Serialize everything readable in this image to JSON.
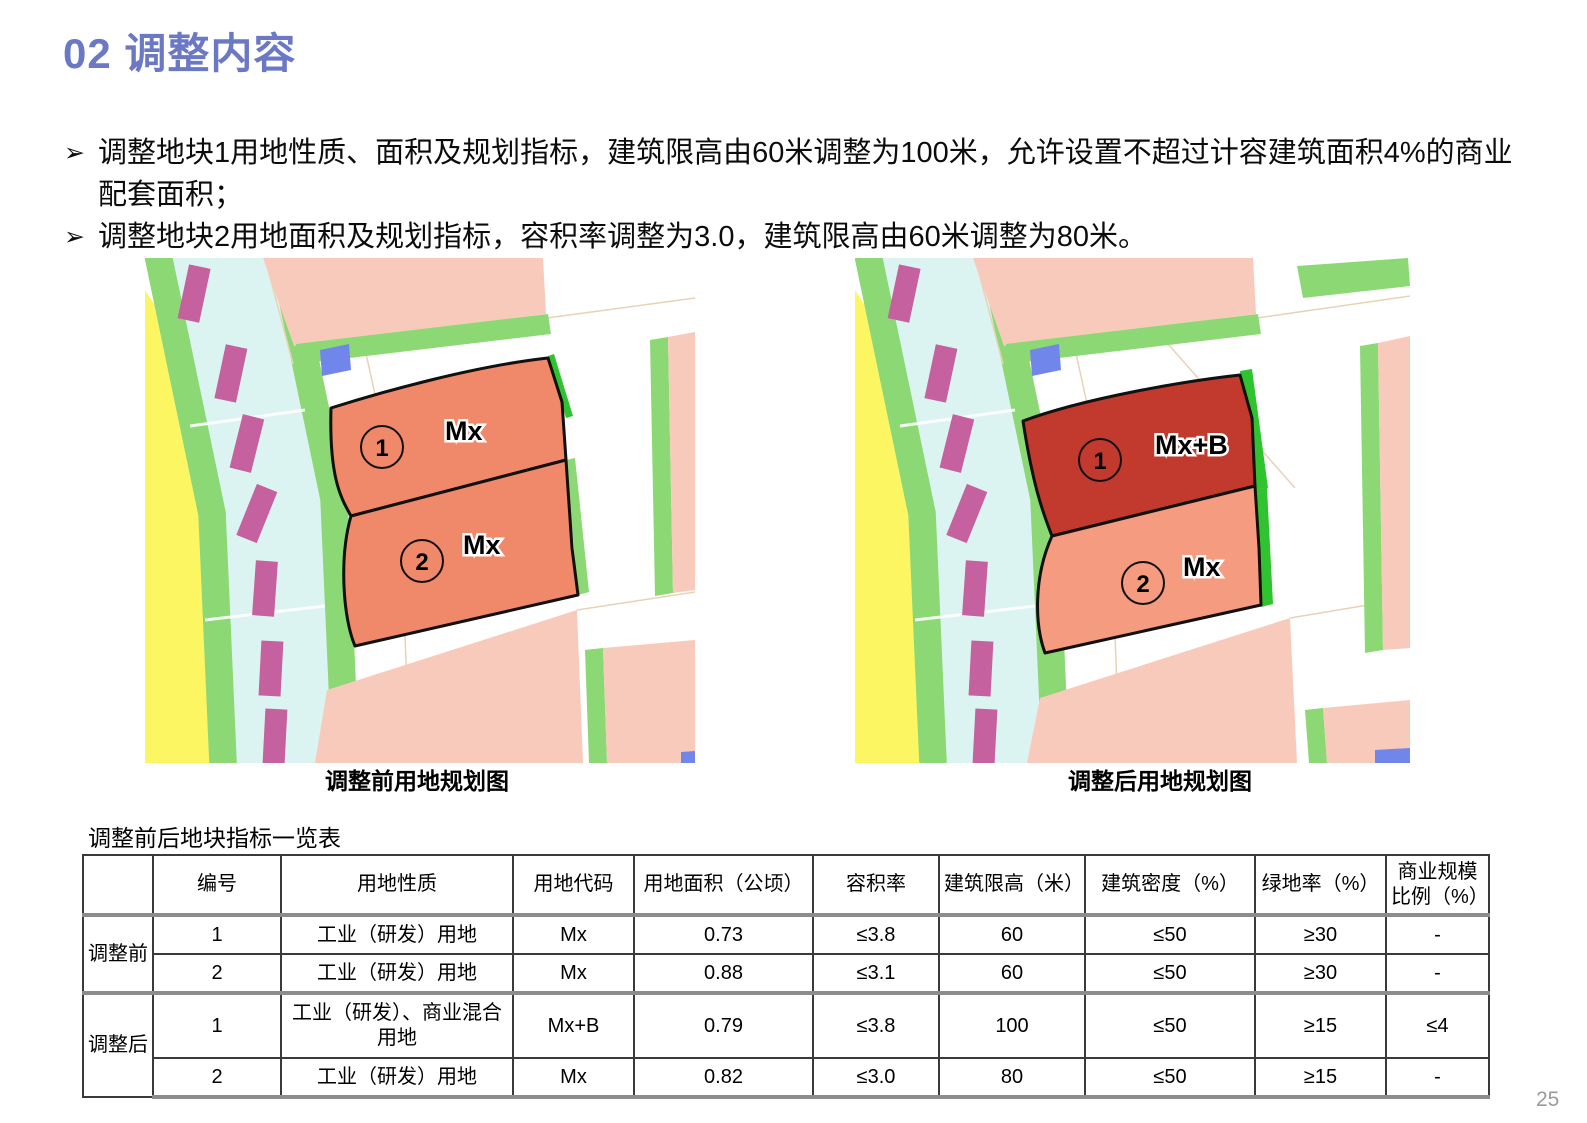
{
  "page_title": "02 调整内容",
  "bullets": {
    "marker": "➢",
    "items": [
      "调整地块1用地性质、面积及规划指标，建筑限高由60米调整为100米，允许设置不超过计容建筑面积4%的商业配套面积；",
      "调整地块2用地面积及规划指标，容积率调整为3.0，建筑限高由60米调整为80米。"
    ]
  },
  "maps": {
    "before": {
      "caption": "调整前用地规划图",
      "parcel1": {
        "num": "1",
        "code": "Mx"
      },
      "parcel2": {
        "num": "2",
        "code": "Mx"
      }
    },
    "after": {
      "caption": "调整后用地规划图",
      "parcel1": {
        "num": "1",
        "code": "Mx+B"
      },
      "parcel2": {
        "num": "2",
        "code": "Mx"
      }
    }
  },
  "table": {
    "title": "调整前后地块指标一览表",
    "headers": [
      "",
      "编号",
      "用地性质",
      "用地代码",
      "用地面积（公顷）",
      "容积率",
      "建筑限高（米）",
      "建筑密度（%）",
      "绿地率（%）",
      "商业规模比例（%）"
    ],
    "groups": [
      {
        "label": "调整前",
        "rows": [
          [
            "1",
            "工业（研发）用地",
            "Mx",
            "0.73",
            "≤3.8",
            "60",
            "≤50",
            "≥30",
            "-"
          ],
          [
            "2",
            "工业（研发）用地",
            "Mx",
            "0.88",
            "≤3.1",
            "60",
            "≤50",
            "≥30",
            "-"
          ]
        ]
      },
      {
        "label": "调整后",
        "rows": [
          [
            "1",
            "工业（研发）、商业混合用地",
            "Mx+B",
            "0.79",
            "≤3.8",
            "100",
            "≤50",
            "≥15",
            "≤4"
          ],
          [
            "2",
            "工业（研发）用地",
            "Mx",
            "0.82",
            "≤3.0",
            "80",
            "≤50",
            "≥15",
            "-"
          ]
        ]
      }
    ]
  },
  "page_number": "25",
  "colors": {
    "title_blue": "#6B79C5",
    "map_yellow": "#FBF662",
    "map_cyan": "#DCF4F1",
    "map_green": "#8BD874",
    "map_bright_green": "#2FC42F",
    "map_magenta": "#C4619E",
    "map_pink": "#F8CABB",
    "map_salmon": "#F0886A",
    "map_salmon_light": "#F49B80",
    "map_dark_red": "#C23A2E",
    "map_blue": "#7186EA",
    "thick_rule_gray": "#8c8c8c"
  }
}
